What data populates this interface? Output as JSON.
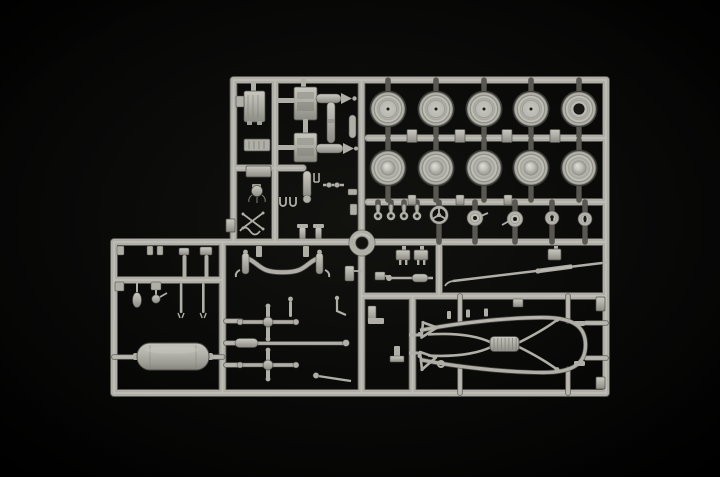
{
  "image": {
    "type": "product-photo",
    "subject": "Light grey injection-moulded model kit sprue (plastic parts tree) photographed on a black background",
    "text_visible": "none"
  },
  "colors": {
    "background": "#090908",
    "plastic_base": "#b0afa7",
    "plastic_light": "#cecdc5",
    "plastic_bright": "#dcdbd3",
    "plastic_mid": "#a09f97",
    "plastic_shadow": "#82817a",
    "plastic_groove": "#8b8a83",
    "plastic_dark": "#4f4e49",
    "hole_dark": "#181816"
  },
  "sprue": {
    "layout": "L-shaped runner frame; wheel grid upper right, small-disc row beneath it, engine parts upper left, suspension rods centre, muffler lower left, ladder chassis frame lower right, ring part at centre junction",
    "wheels": {
      "columns_x": [
        388,
        436,
        484,
        531,
        579
      ],
      "row1_y": 109,
      "row2_y": 168,
      "radius": 18,
      "large_bore_column": 4,
      "row1_style": "flat face with tiny centre pin mark",
      "row2_style": "domed hub cap"
    },
    "small_parts_row": {
      "hooks_x": [
        378,
        391,
        404,
        417
      ],
      "hooks_y": 216,
      "steering_wheel": {
        "x": 439,
        "y": 215,
        "r": 9,
        "spokes": 3
      },
      "discs": [
        {
          "x": 475,
          "y": 218,
          "r": 8,
          "style": "hole-arm-right"
        },
        {
          "x": 515,
          "y": 219,
          "r": 8,
          "style": "hole-arm-left"
        },
        {
          "x": 552,
          "y": 218,
          "r": 7,
          "style": "keyhole"
        },
        {
          "x": 585,
          "y": 219,
          "r": 7,
          "style": "slot"
        }
      ]
    },
    "parts_inventory": [
      {
        "part": "road wheel, flat face",
        "count": 4
      },
      {
        "part": "road wheel, open centre bore",
        "count": 1
      },
      {
        "part": "road wheel, domed hub",
        "count": 5
      },
      {
        "part": "three-spoke steering wheel",
        "count": 1
      },
      {
        "part": "brake drum / pulley disc",
        "count": 4
      },
      {
        "part": "eyelet pin",
        "count": 4
      },
      {
        "part": "engine block half with manifold arm",
        "count": 2
      },
      {
        "part": "radiator block",
        "count": 1
      },
      {
        "part": "exhaust muffler",
        "count": 1
      },
      {
        "part": "ladder chassis frame with ribbed coupling",
        "count": 1
      },
      {
        "part": "drop-centre front axle",
        "count": 1
      },
      {
        "part": "cross axle shaft",
        "count": 2
      },
      {
        "part": "long tie rod",
        "count": 1
      },
      {
        "part": "steering column rod",
        "count": 1
      },
      {
        "part": "shock absorber",
        "count": 2
      },
      {
        "part": "round ring gasket",
        "count": 1
      },
      {
        "part": "assorted small brackets, levers and linkages",
        "count": 18
      }
    ]
  }
}
